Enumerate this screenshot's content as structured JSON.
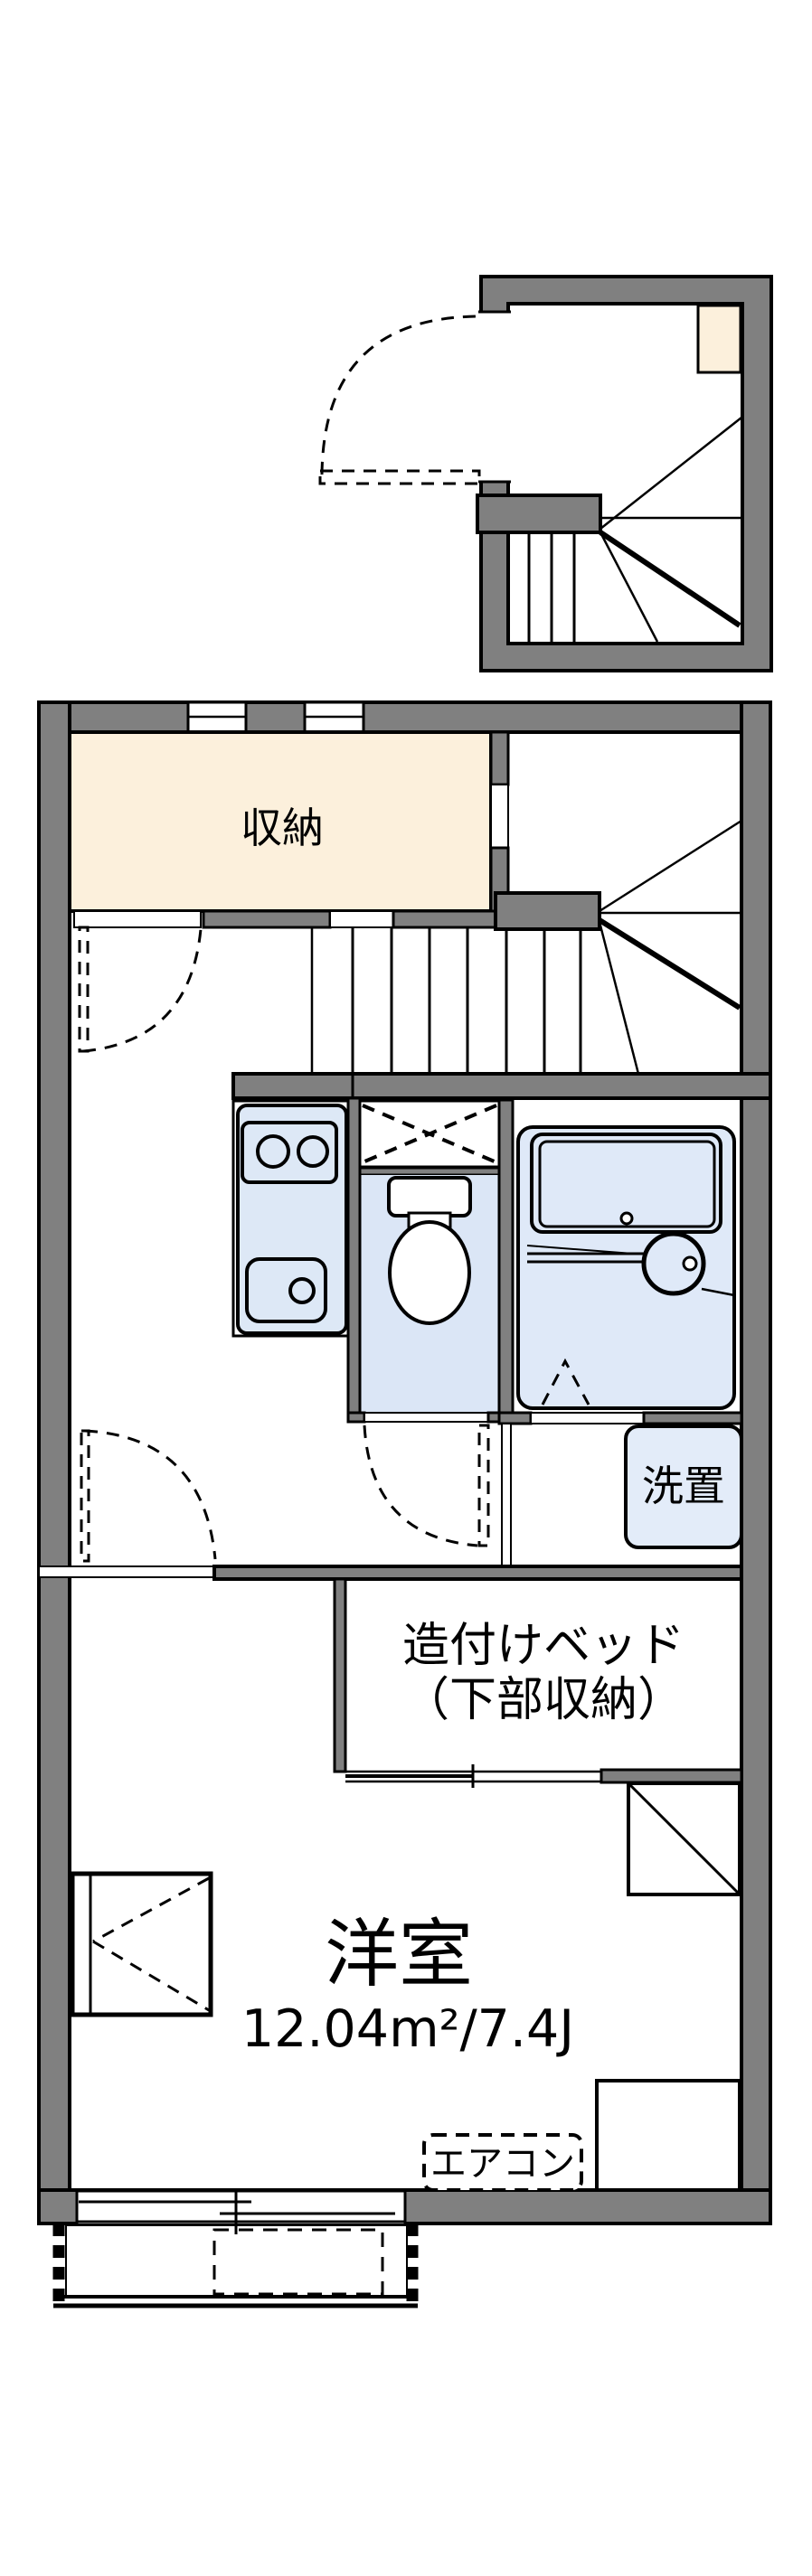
{
  "plan_title": "one-room apartment floor plan",
  "colors": {
    "wall": "#808080",
    "line": "#000000",
    "paper": "#ffffff",
    "storage_fill": "#fcf0dc",
    "fixture_fill": "#dde8f6",
    "toilet_floor_fill": "#dbe6f6",
    "bath_floor_fill": "#dfe9f8",
    "laundry_fill": "#e3ecf9"
  },
  "rooms": {
    "storage": {
      "label": "収納"
    },
    "western_room": {
      "label": "洋室",
      "area_label": "12.04m²/7.4J",
      "area_m2": "12.04",
      "area_jo": "7.4"
    },
    "built_in_bed": {
      "label_line1": "造付けベッド",
      "label_line2": "（下部収納）"
    },
    "laundry_space": {
      "label": "洗置"
    },
    "air_conditioner": {
      "label": "エアコン"
    }
  }
}
